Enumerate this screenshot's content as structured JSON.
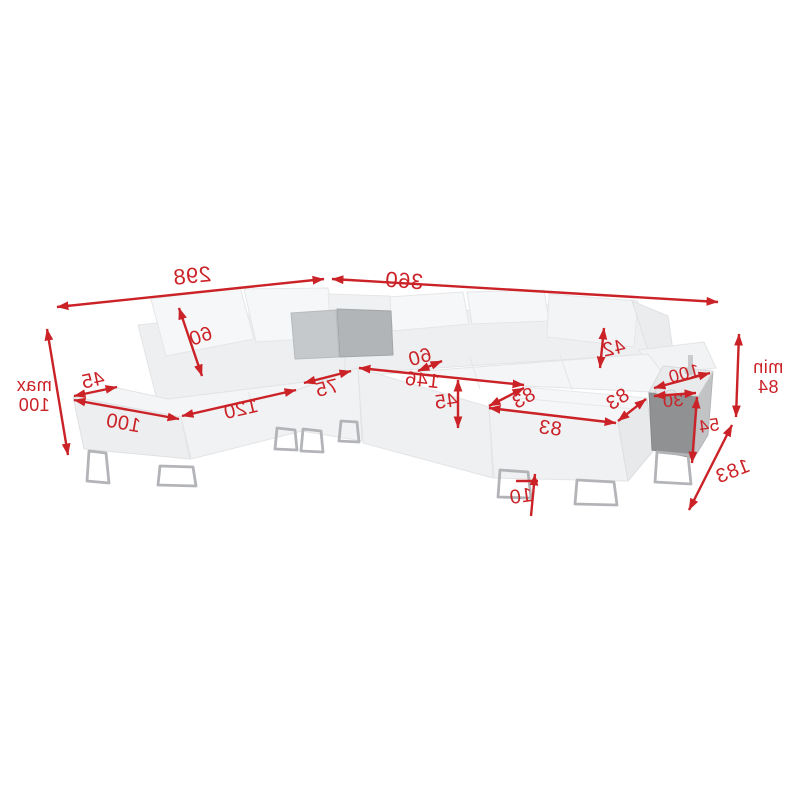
{
  "image": {
    "kind": "product-dimension-diagram",
    "subject": "corner-sofa-with-chaise-and-side-table"
  },
  "colors": {
    "dimension_red": "#cb2227",
    "background": "#ffffff",
    "sofa_body": "#f4f5f6",
    "pillow_dark": "#b2b5b8",
    "pillow_light": "#c6c9cb",
    "table_front": "#8f9193",
    "table_side": "#c1c3c5",
    "leg_metal": "#b2b4b7"
  },
  "dims": {
    "total_left": "298",
    "total_right": "360",
    "max_word": "max",
    "max_value": "100",
    "headrest_left_height": "60",
    "armrest_width": "45",
    "side_depth": "100",
    "seat_left_length": "120",
    "seat_small_length": "75",
    "bed_length": "146",
    "seat_gap": "60",
    "seat_height": "45",
    "headrest_right_height": "42",
    "chaise_side_a": "83",
    "chaise_side_b": "83",
    "chaise_front": "83",
    "table_top_depth": "100",
    "table_width": "30",
    "table_height": "54",
    "min_word": "min",
    "min_value": "84",
    "total_depth": "183",
    "leg_height": "10"
  }
}
